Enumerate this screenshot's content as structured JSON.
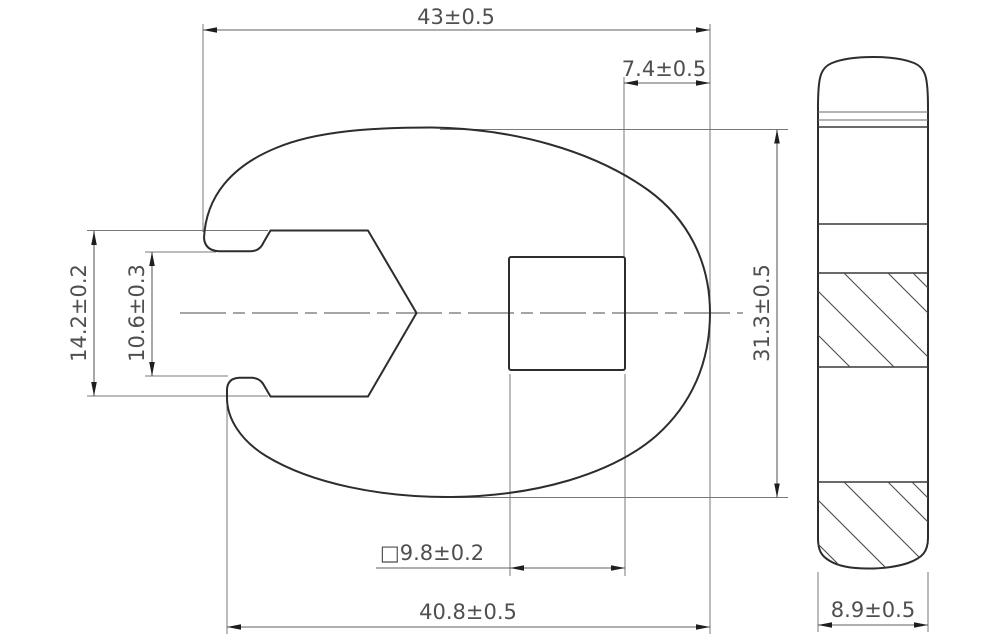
{
  "drawing": {
    "title": "crowfoot-flare-nut-wrench-technical-drawing",
    "views": {
      "main_view": "front view with jaw opening and square drive",
      "side_view": "side profile with hatched sections"
    },
    "dimensions": {
      "overall_width": "43±0.5",
      "drive_offset": "7.4±0.5",
      "jaw_opening": "14.2±0.2",
      "throat_opening": "10.6±0.3",
      "body_height": "31.3±0.5",
      "square_drive": "□9.8±0.2",
      "lower_width": "40.8±0.5",
      "profile_thickness": "8.9±0.5"
    },
    "colors": {
      "background": "#ffffff",
      "outline": "#2d2d2d",
      "thin_line": "#787878",
      "text": "#4f4f4f"
    }
  }
}
